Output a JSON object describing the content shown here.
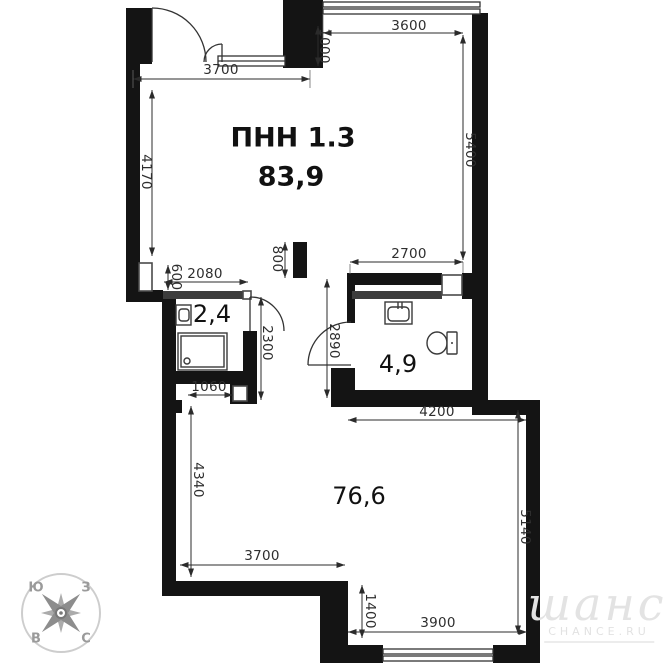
{
  "plan": {
    "unit_label": "ПНН 1.3",
    "unit_area": "83,9",
    "room_storage_area": "2,4",
    "room_bath_area": "4,9",
    "room_main_area": "76,6",
    "dims": {
      "d3700_top": "3700",
      "d1000": "1000",
      "d3600": "3600",
      "d4170": "4170",
      "d5400": "5400",
      "d2700": "2700",
      "d800": "800",
      "d2080": "2080",
      "d600": "600",
      "d2300": "2300",
      "d2890": "2890",
      "d1060": "1060",
      "d4200": "4200",
      "d4340": "4340",
      "d3700_bottom": "3700",
      "d5140": "5140",
      "d1400": "1400",
      "d3900": "3900"
    },
    "compass": {
      "south": "Ю",
      "west": "З",
      "east": "В",
      "north": "С"
    },
    "watermark": {
      "script": "шанс",
      "caption": "CHANCE.RU"
    },
    "colors": {
      "wall": "#141414",
      "partition": "#3d3d3d",
      "dim_line": "#2b2b2b"
    }
  }
}
